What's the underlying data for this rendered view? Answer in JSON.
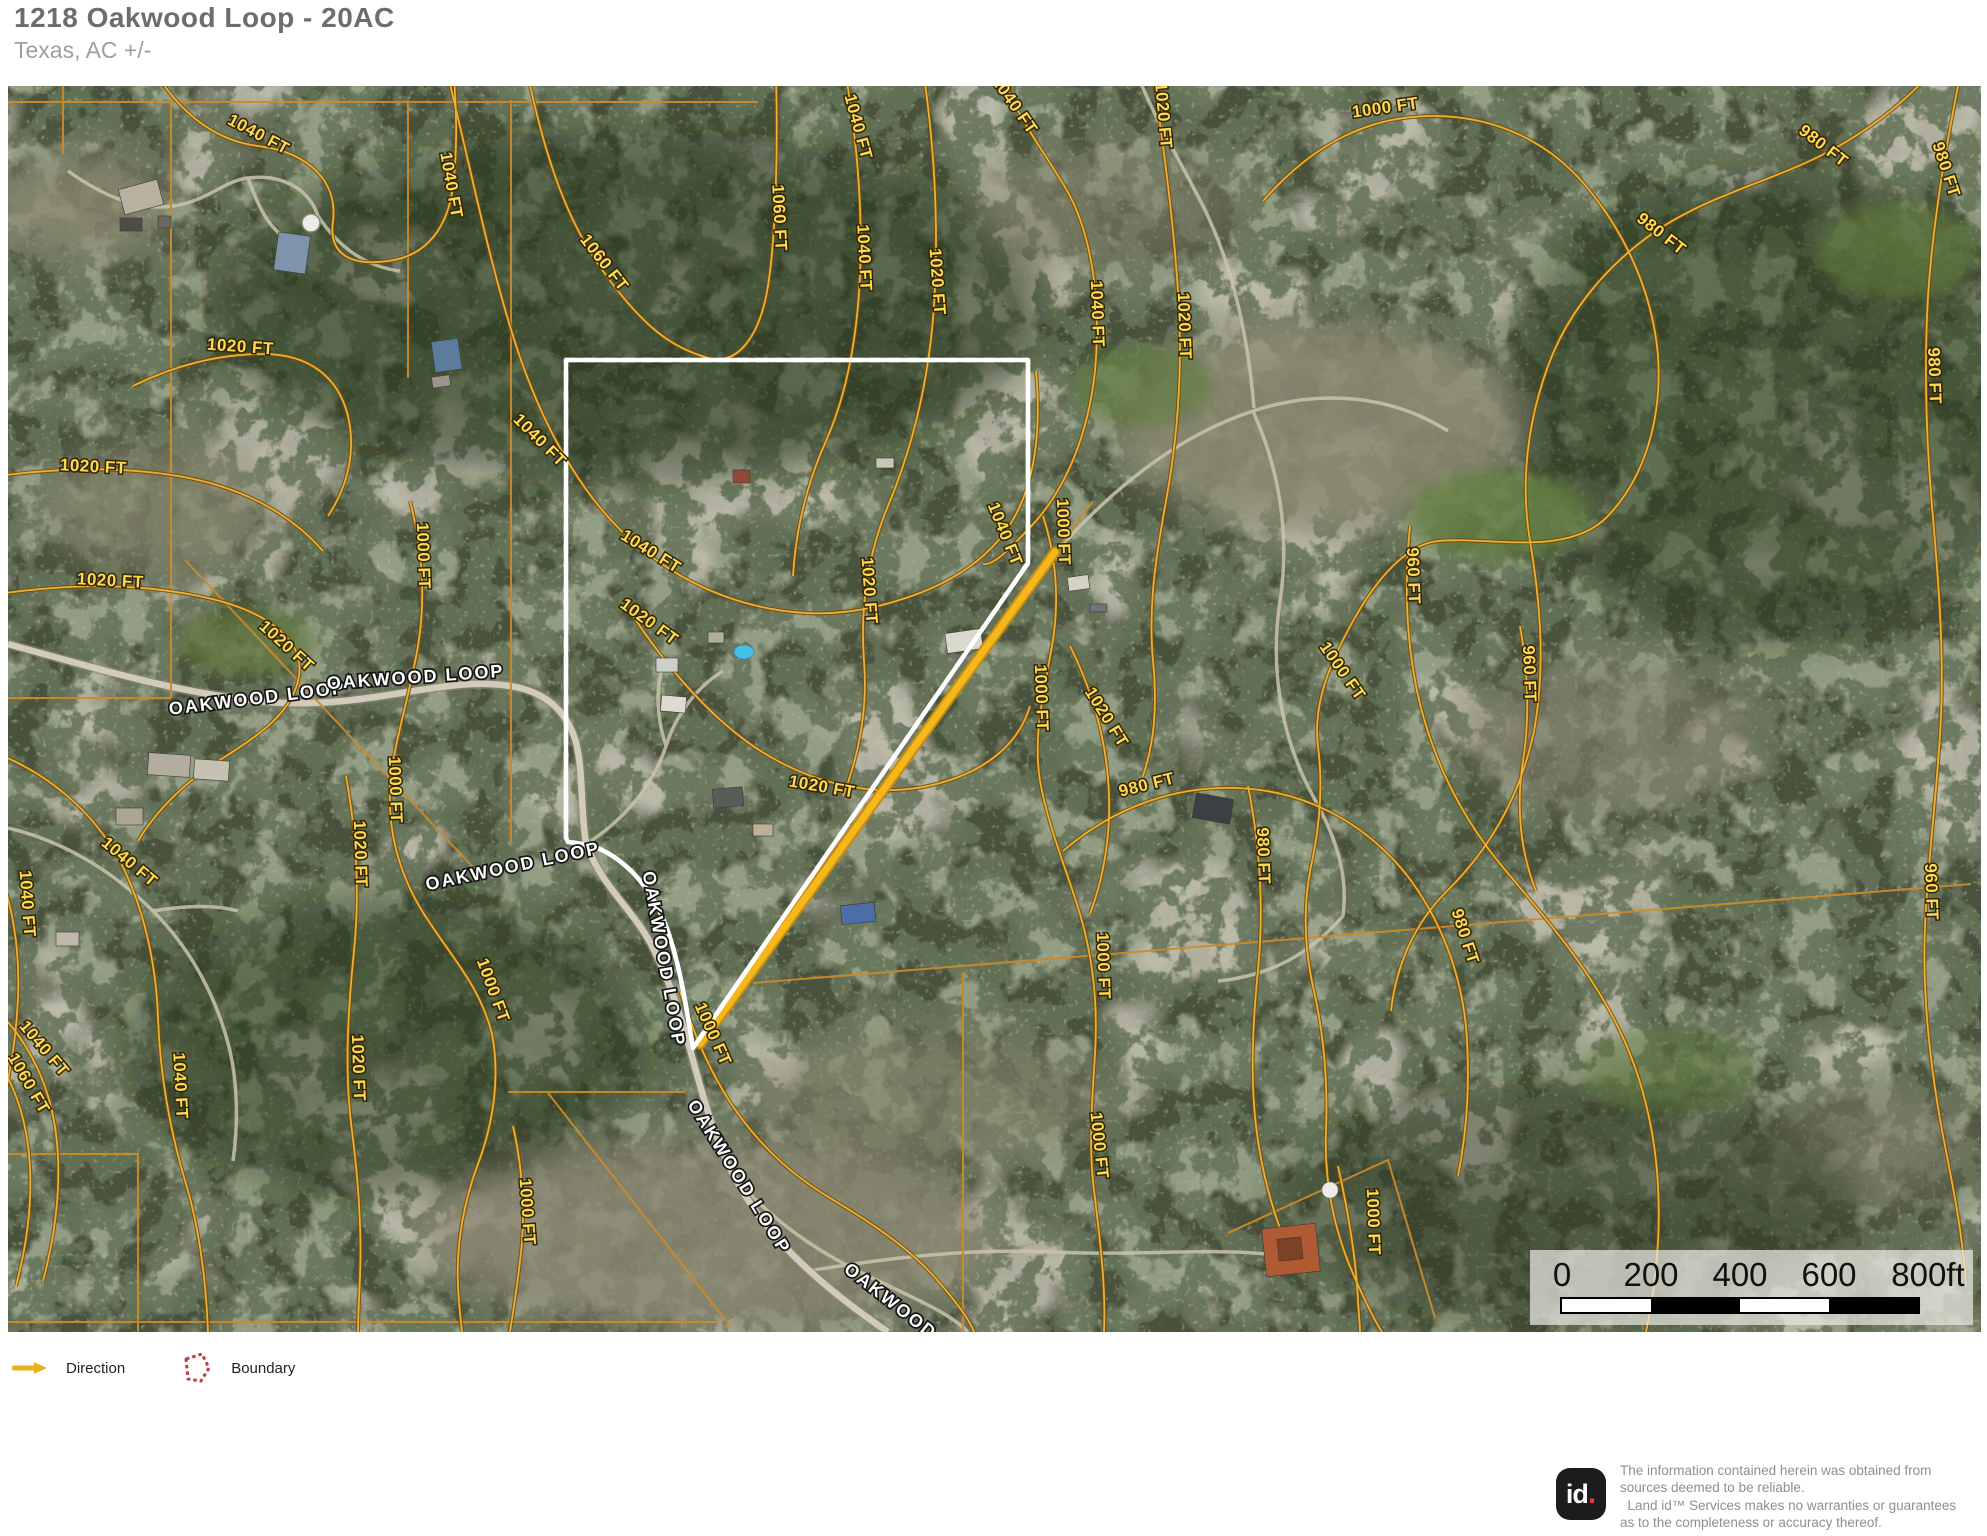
{
  "header": {
    "title": "1218 Oakwood Loop - 20AC",
    "subtitle": "Texas,  AC +/-"
  },
  "map": {
    "colors": {
      "boundary_red": "#d22128",
      "direction_yellow": "#f0b011",
      "contour_orange": "#f1b033",
      "parcel_orange": "#cd8a2a"
    },
    "contour_labels": [
      {
        "text": "1040 FT",
        "x": 248,
        "y": 53,
        "rot": 28
      },
      {
        "text": "1040 FT",
        "x": 438,
        "y": 100,
        "rot": 80
      },
      {
        "text": "1060 FT",
        "x": 592,
        "y": 180,
        "rot": 52
      },
      {
        "text": "1060 FT",
        "x": 766,
        "y": 132,
        "rot": 87
      },
      {
        "text": "1040 FT",
        "x": 845,
        "y": 42,
        "rot": 75
      },
      {
        "text": "1040 FT",
        "x": 1002,
        "y": 22,
        "rot": 55
      },
      {
        "text": "1020 FT",
        "x": 1150,
        "y": 30,
        "rot": 85
      },
      {
        "text": "1000 FT",
        "x": 1378,
        "y": 27,
        "rot": -8
      },
      {
        "text": "980 FT",
        "x": 1650,
        "y": 152,
        "rot": 38
      },
      {
        "text": "980 FT",
        "x": 1812,
        "y": 64,
        "rot": 38
      },
      {
        "text": "980 FT",
        "x": 1933,
        "y": 85,
        "rot": 72
      },
      {
        "text": "980 FT",
        "x": 1921,
        "y": 290,
        "rot": 88
      },
      {
        "text": "1040 FT",
        "x": 1084,
        "y": 228,
        "rot": 88
      },
      {
        "text": "1020 FT",
        "x": 1171,
        "y": 240,
        "rot": 88
      },
      {
        "text": "1040 FT",
        "x": 851,
        "y": 172,
        "rot": 87
      },
      {
        "text": "1020 FT",
        "x": 924,
        "y": 196,
        "rot": 86
      },
      {
        "text": "1040 FT",
        "x": 528,
        "y": 358,
        "rot": 45
      },
      {
        "text": "1040 FT",
        "x": 640,
        "y": 470,
        "rot": 32
      },
      {
        "text": "1040 FT",
        "x": 992,
        "y": 450,
        "rot": 68
      },
      {
        "text": "1000 FT",
        "x": 1050,
        "y": 446,
        "rot": 88
      },
      {
        "text": "1020 FT",
        "x": 856,
        "y": 505,
        "rot": 86
      },
      {
        "text": "1020 FT",
        "x": 638,
        "y": 540,
        "rot": 36
      },
      {
        "text": "1020 FT",
        "x": 813,
        "y": 706,
        "rot": 10
      },
      {
        "text": "1020 FT",
        "x": 232,
        "y": 266,
        "rot": 4
      },
      {
        "text": "1020 FT",
        "x": 85,
        "y": 386,
        "rot": 3
      },
      {
        "text": "1020 FT",
        "x": 102,
        "y": 500,
        "rot": 3
      },
      {
        "text": "1020 FT",
        "x": 275,
        "y": 564,
        "rot": 42
      },
      {
        "text": "1000 FT",
        "x": 410,
        "y": 470,
        "rot": 88
      },
      {
        "text": "1000 FT",
        "x": 382,
        "y": 704,
        "rot": 88
      },
      {
        "text": "1040 FT",
        "x": 118,
        "y": 780,
        "rot": 40
      },
      {
        "text": "1040 FT",
        "x": 14,
        "y": 818,
        "rot": 86
      },
      {
        "text": "1020 FT",
        "x": 347,
        "y": 768,
        "rot": 88
      },
      {
        "text": "1000 FT",
        "x": 480,
        "y": 906,
        "rot": 70
      },
      {
        "text": "1000 FT",
        "x": 700,
        "y": 950,
        "rot": 66
      },
      {
        "text": "1040 FT",
        "x": 32,
        "y": 966,
        "rot": 50
      },
      {
        "text": "1060 FT",
        "x": 16,
        "y": 1000,
        "rot": 60
      },
      {
        "text": "1040 FT",
        "x": 167,
        "y": 1000,
        "rot": 87
      },
      {
        "text": "1020 FT",
        "x": 345,
        "y": 982,
        "rot": 88
      },
      {
        "text": "1000 FT",
        "x": 514,
        "y": 1126,
        "rot": 86
      },
      {
        "text": "1000 FT",
        "x": 1028,
        "y": 612,
        "rot": 88
      },
      {
        "text": "1020 FT",
        "x": 1094,
        "y": 634,
        "rot": 58
      },
      {
        "text": "1000 FT",
        "x": 1330,
        "y": 588,
        "rot": 55
      },
      {
        "text": "980 FT",
        "x": 1452,
        "y": 852,
        "rot": 72
      },
      {
        "text": "980 FT",
        "x": 1140,
        "y": 704,
        "rot": -14
      },
      {
        "text": "980 FT",
        "x": 1250,
        "y": 770,
        "rot": 88
      },
      {
        "text": "1000 FT",
        "x": 1090,
        "y": 880,
        "rot": 88
      },
      {
        "text": "960 FT",
        "x": 1400,
        "y": 490,
        "rot": 88
      },
      {
        "text": "960 FT",
        "x": 1516,
        "y": 588,
        "rot": 88
      },
      {
        "text": "960 FT",
        "x": 1918,
        "y": 806,
        "rot": 88
      },
      {
        "text": "1000 FT",
        "x": 1360,
        "y": 1136,
        "rot": 88
      },
      {
        "text": "1000 FT",
        "x": 1086,
        "y": 1060,
        "rot": 84
      }
    ],
    "road_labels": [
      {
        "text": "OAKWOOD LOOP",
        "x": 250,
        "y": 618,
        "rot": -7
      },
      {
        "text": "OAKWOOD LOOP",
        "x": 408,
        "y": 597,
        "rot": -4
      },
      {
        "text": "OAKWOOD LOOP",
        "x": 506,
        "y": 786,
        "rot": -12
      },
      {
        "text": "OAKWOOD LOOP",
        "x": 650,
        "y": 874,
        "rot": 80
      },
      {
        "text": "OAKWOOD LOOP",
        "x": 726,
        "y": 1094,
        "rot": 58
      },
      {
        "text": "OAKWOOD LOOP",
        "x": 905,
        "y": 1240,
        "rot": 38
      }
    ]
  },
  "scale_bar": {
    "labels": [
      "0",
      "200",
      "400",
      "600",
      "800ft"
    ]
  },
  "legend": {
    "direction_label": "Direction",
    "boundary_label": "Boundary"
  },
  "footer": {
    "logo_id": "id",
    "logo_dot": ".",
    "disclaimer_lines": [
      "The information contained herein was obtained from",
      "sources deemed to be reliable.",
      "  Land id™ Services makes no warranties or guarantees",
      "as to the completeness or accuracy thereof."
    ]
  }
}
